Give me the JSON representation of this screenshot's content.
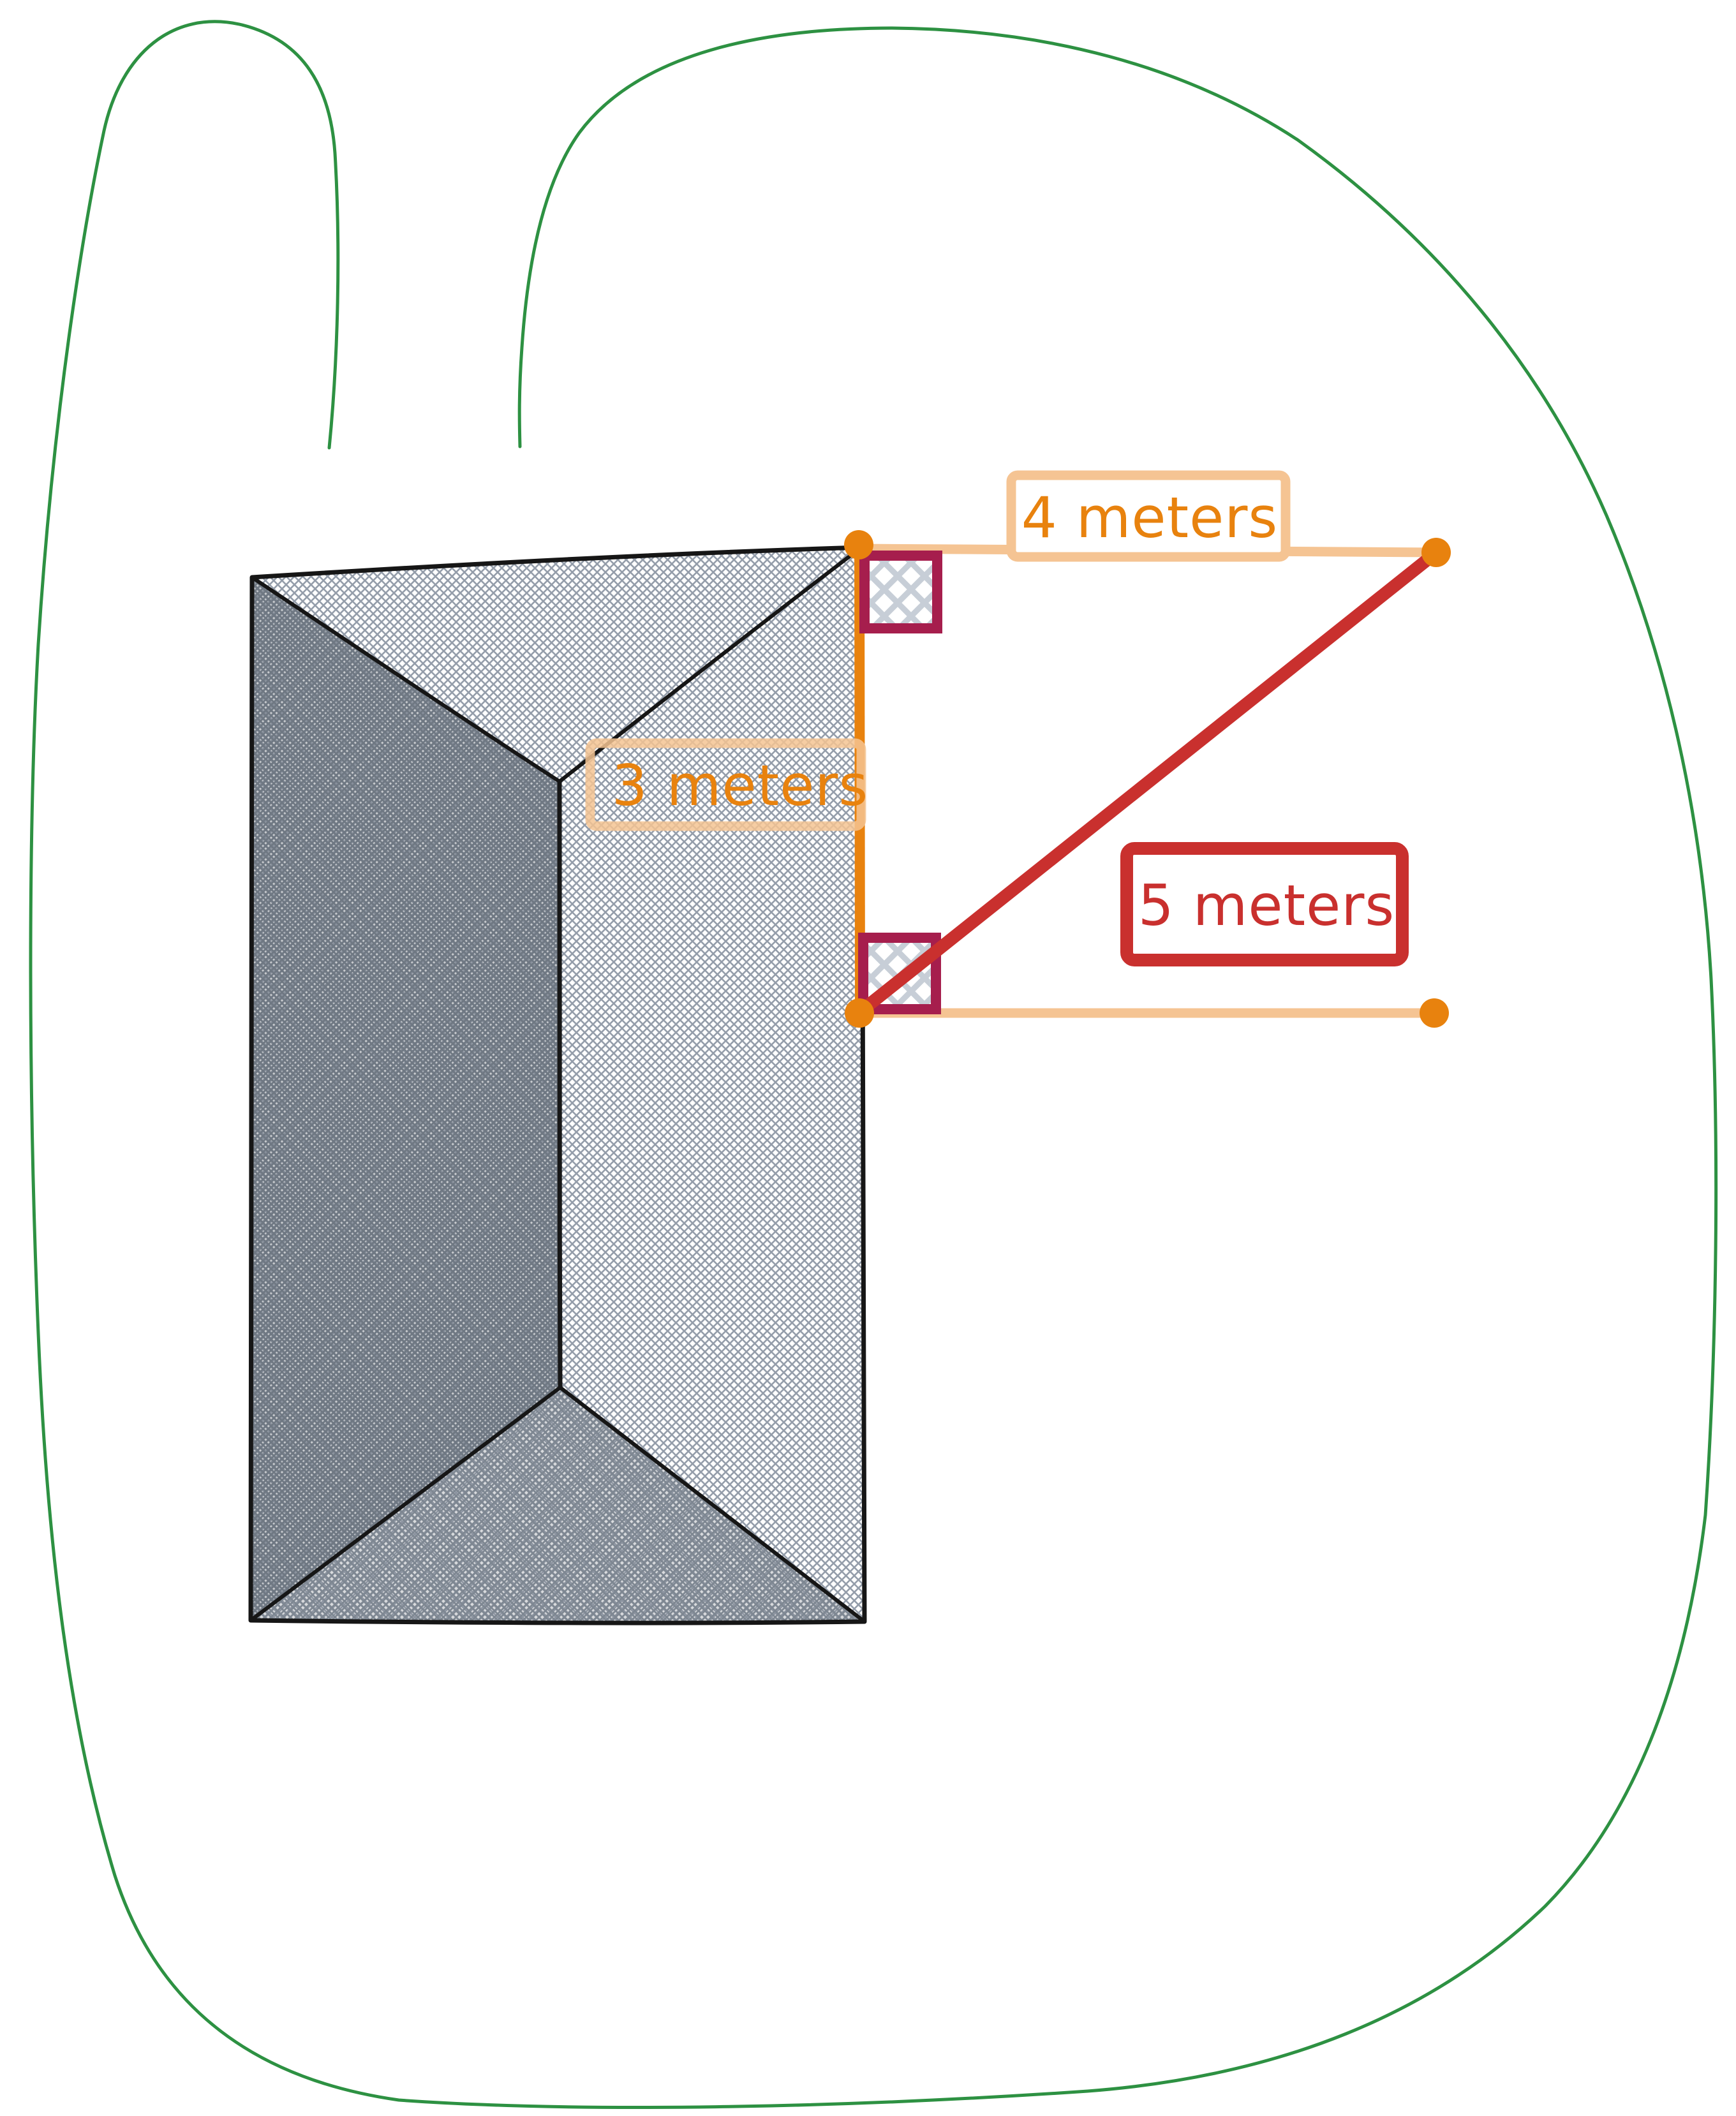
{
  "canvas": {
    "background": "#ffffff"
  },
  "garden": {
    "boundary_color": "#2d9142"
  },
  "house": {
    "outline_color": "#161616",
    "hatch_color": "#949daa",
    "dark_face_tint": "#747d87"
  },
  "measurements": {
    "top": {
      "label": "4 meters",
      "value_m": 4,
      "line_color": "#f5c493",
      "text_color": "#e8820e"
    },
    "side": {
      "label": "3 meters",
      "value_m": 3,
      "line_color": "#e8820e",
      "text_color": "#e8820e"
    },
    "diagonal": {
      "label": "5 meters",
      "value_m": 5,
      "line_color": "#c9302e",
      "text_color": "#c9302e"
    },
    "offset_line_color": "#f5c493",
    "endpoint_dot_color": "#e8820e",
    "right_angle_marker_color": "#a61e4d",
    "marker_hatch_color": "#c7ced7"
  }
}
